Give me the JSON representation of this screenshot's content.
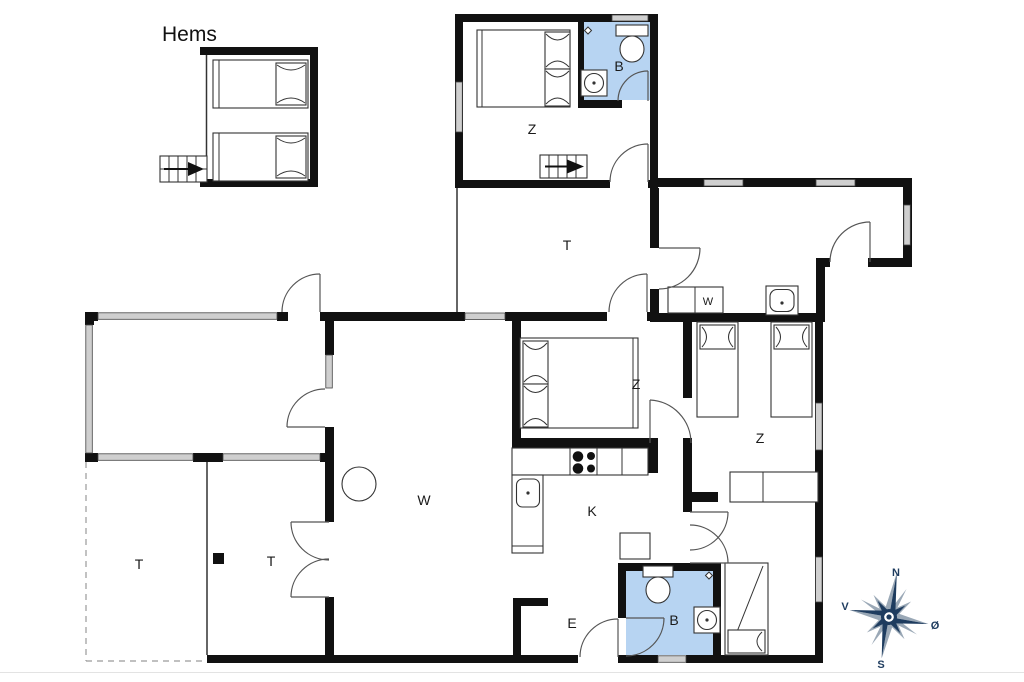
{
  "plan": {
    "loft_label": "Hems",
    "rooms": {
      "bedroom_top": "Z",
      "bathroom_top": "B",
      "hallway": "T",
      "bedroom_middle": "Z",
      "bedroom_right": "Z",
      "living_room": "W",
      "kitchen": "K",
      "entry": "E",
      "bathroom_bottom": "B",
      "terrace_left": "T",
      "terrace_right": "T",
      "washer": "W"
    },
    "compass": {
      "north": "N",
      "east": "Ø",
      "south": "S",
      "west": "V"
    },
    "colors": {
      "wall": "#111111",
      "window_fill": "#cfcfcf",
      "bathroom_fill": "#b7d4f2",
      "compass_primary": "#1e3c5f",
      "compass_secondary": "#9aa8b6"
    }
  }
}
